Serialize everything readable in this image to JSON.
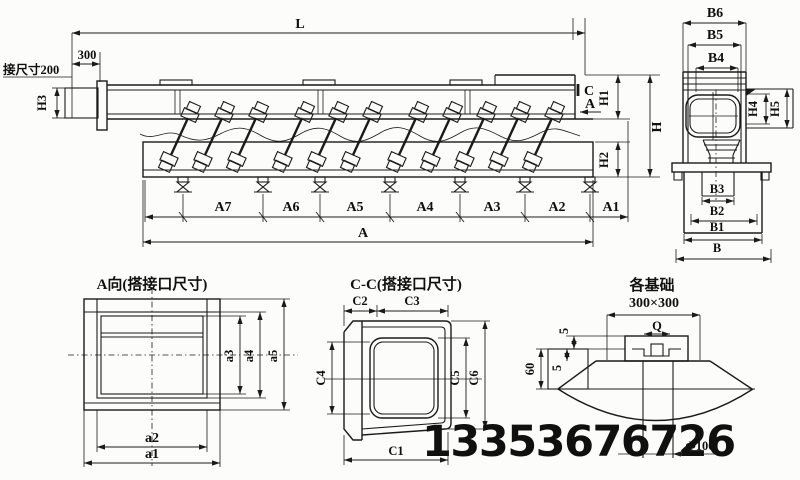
{
  "watermark": "13353676726",
  "side_view": {
    "length_label": "L",
    "inlet_length": "300",
    "inlet_note": "接尺寸200",
    "inlet_height": "H3",
    "section_mark": "C",
    "view_arrow_label": "A",
    "h1": "H1",
    "h": "H",
    "h2": "H2",
    "spans": [
      "A7",
      "A6",
      "A5",
      "A4",
      "A3",
      "A2",
      "A1"
    ],
    "total_span": "A"
  },
  "end_view": {
    "b6": "B6",
    "b5": "B5",
    "b4": "B4",
    "h4": "H4",
    "h5": "H5",
    "b3": "B3",
    "b2": "B2",
    "b1": "B1",
    "b": "B"
  },
  "a_view": {
    "title": "A向(搭接口尺寸)",
    "a3": "a3",
    "a4": "a4",
    "a5": "a5",
    "a2": "a2",
    "a1": "a1"
  },
  "cc_view": {
    "title": "C-C(搭接口尺寸)",
    "c2": "C2",
    "c3": "C3",
    "c4": "C4",
    "c5": "C5",
    "c6": "C6",
    "c1": "C1"
  },
  "foundation_view": {
    "title": "各基础",
    "size": "300×300",
    "bolt_label": "Q",
    "gap_top": "5",
    "depth": "60",
    "gap_bottom": "5",
    "hole": "Φ100"
  }
}
